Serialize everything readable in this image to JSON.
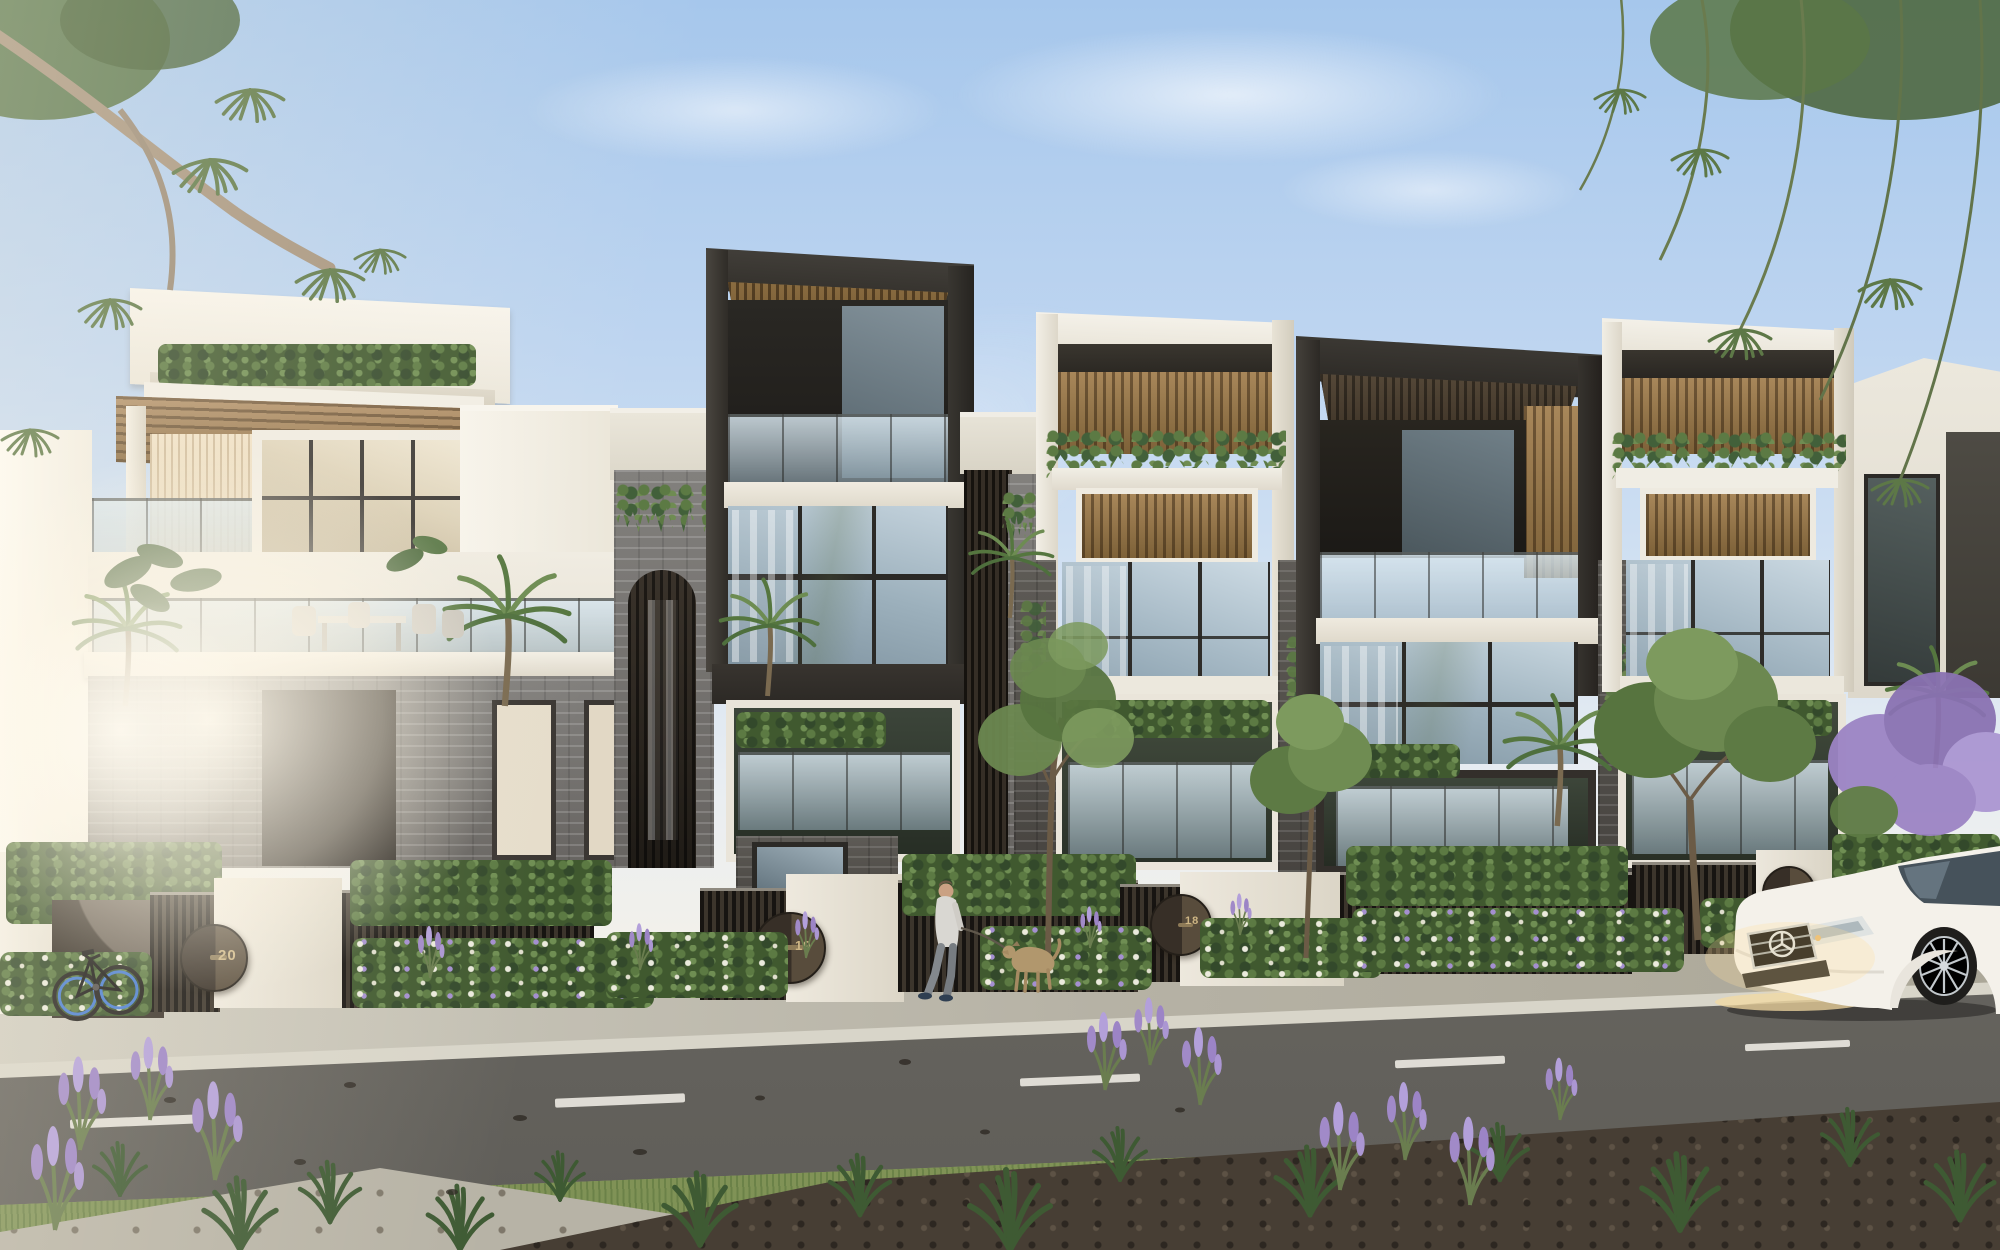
{
  "scene": {
    "type": "architectural-render-exterior",
    "subject": "modern-townhouse-terrace-row-street-view"
  },
  "palette": {
    "sky_top": "#a6c7ec",
    "sky_horizon": "#f3f1ea",
    "render_white": "#ece8de",
    "timber": "#a3835a",
    "charcoal": "#36332f",
    "bronze_slat": "#473f34",
    "brick_light": "#7b7876",
    "brick_dark": "#55524e",
    "glass_cool": "#b3c4cf",
    "glass_warm": "#e3d8c0",
    "road": "#6f6d68",
    "sidewalk": "#bdb9ad",
    "grass": "#93a46a",
    "foliage": "#58743f",
    "lavender": "#a18ac8",
    "mulch": "#4e443a",
    "gate_number_gold": "#cdb584",
    "car_white": "#f4f1ea"
  },
  "gates": {
    "g1": {
      "number": "20"
    },
    "g2": {
      "number": "19"
    },
    "g3": {
      "number": "18"
    },
    "g4": {
      "number": "17"
    }
  },
  "street": {
    "marking": "dashed-centre-line",
    "marking_color": "#e9e7e0"
  },
  "car": {
    "make_badge": "mercedes-star",
    "body_color": "#f4f1ea",
    "wheel": "multi-spoke-alloy"
  },
  "figures": {
    "pedestrian": "man-walking-dog",
    "dog": "tan-dog-on-leash"
  },
  "objects": {
    "bicycle": "city-bike-blue-rims"
  },
  "vegetation": {
    "left_corner": "eucalyptus-branch",
    "right_corner": "weeping-eucalyptus",
    "street_trees": 3,
    "palms": 6,
    "flower_accent": "purple-salvia-lavender"
  }
}
